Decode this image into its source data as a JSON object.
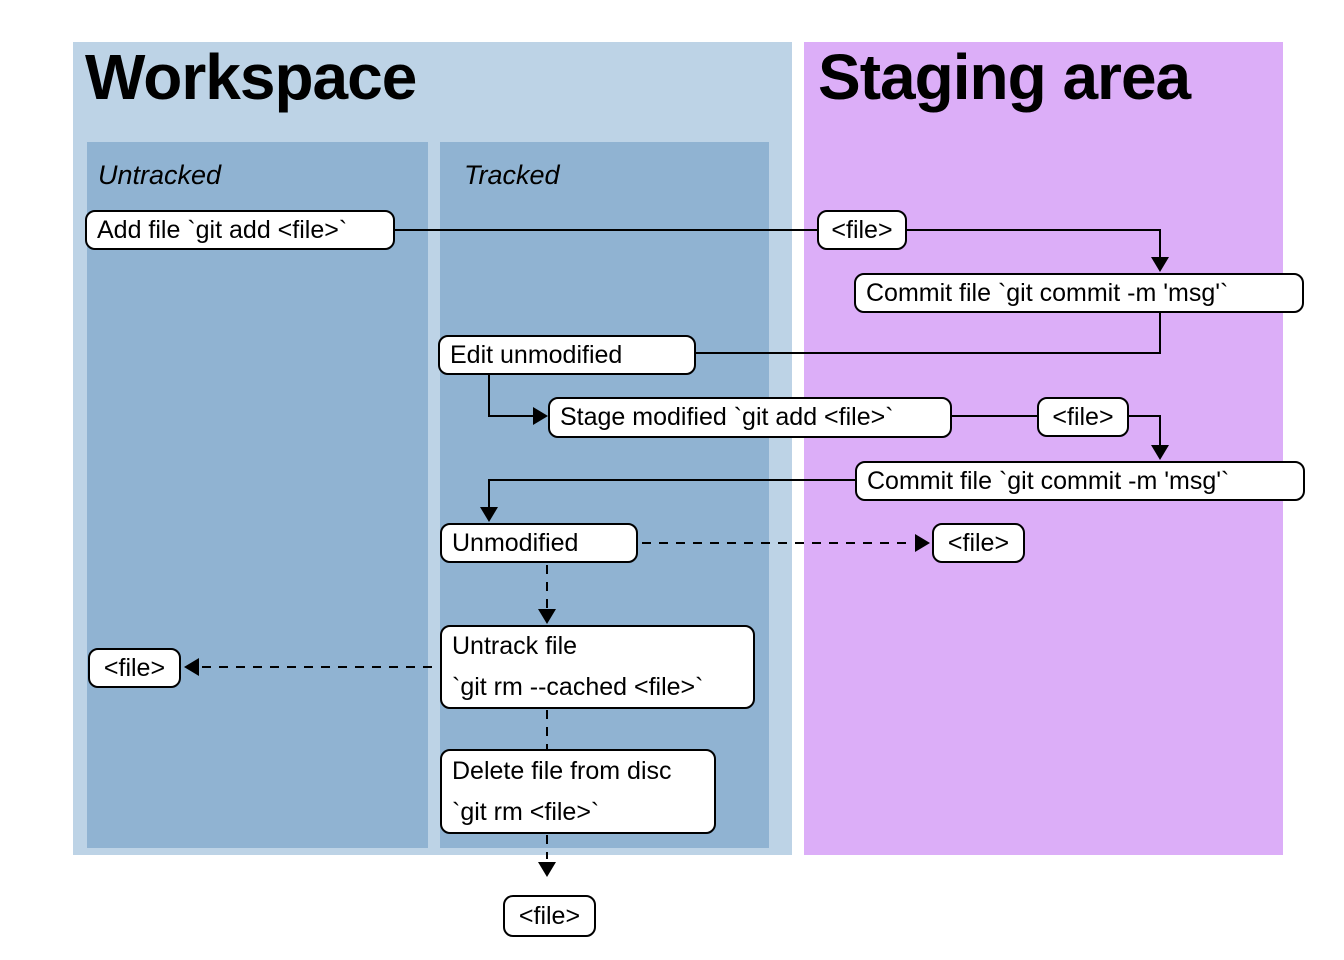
{
  "colors": {
    "workspace_bg": "#bdd3e6",
    "column_bg": "#90b3d2",
    "staging_bg": "#dcaef8",
    "node_bg": "#ffffff",
    "line_color": "#000000"
  },
  "panels": {
    "workspace": {
      "title": "Workspace"
    },
    "staging": {
      "title": "Staging area"
    }
  },
  "columns": {
    "untracked": {
      "label": "Untracked"
    },
    "tracked": {
      "label": "Tracked"
    }
  },
  "nodes": {
    "add_file": {
      "label": "Add file `git add <file>`"
    },
    "file_top_staging": {
      "label": "<file>"
    },
    "commit_1": {
      "label": "Commit file `git commit -m 'msg'`"
    },
    "edit_unmodified": {
      "label": "Edit unmodified"
    },
    "stage_modified": {
      "label": "Stage modified `git add <file>`"
    },
    "file_mid_staging": {
      "label": "<file>"
    },
    "commit_2": {
      "label": "Commit file `git commit -m 'msg'`"
    },
    "unmodified": {
      "label": "Unmodified"
    },
    "file_staged": {
      "label": "<file>"
    },
    "untrack_file": {
      "line1": "Untrack file",
      "line2": "`git rm --cached <file>`"
    },
    "file_untracked": {
      "label": "<file>"
    },
    "delete_file": {
      "line1": "Delete file from disc",
      "line2": "`git rm <file>`"
    },
    "file_deleted": {
      "label": "<file>"
    }
  }
}
